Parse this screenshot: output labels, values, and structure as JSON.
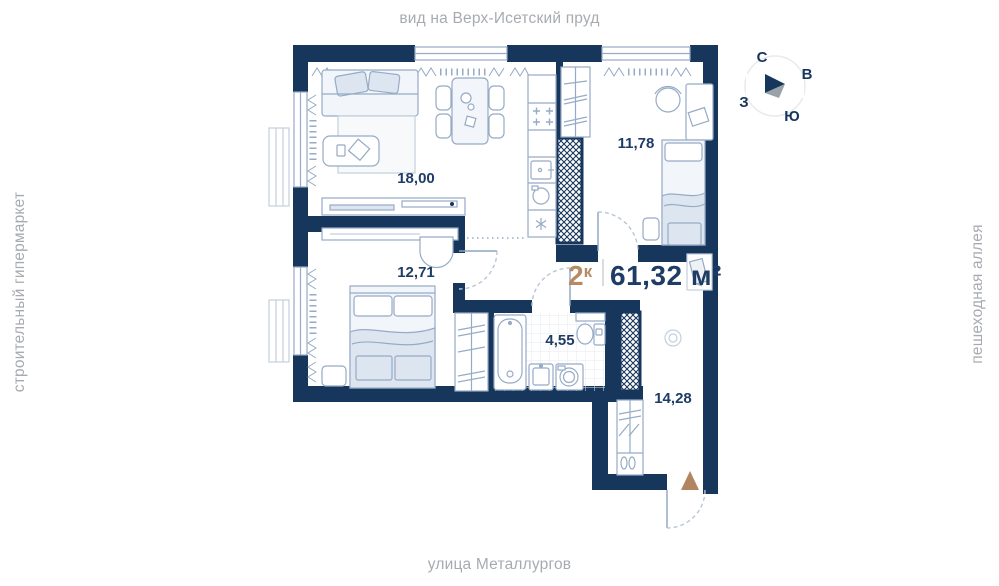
{
  "surroundings": {
    "top": "вид на Верх-Исетский пруд",
    "bottom": "улица Металлургов",
    "left": "строительный гипермаркет",
    "right": "пешеходная аллея"
  },
  "compass": {
    "north": "С",
    "east": "В",
    "south": "Ю",
    "west": "З"
  },
  "apartment": {
    "rooms_count": "2",
    "rooms_suffix": "к",
    "area": "61,32 м²"
  },
  "rooms": [
    {
      "name": "living-kitchen",
      "area": "18,00"
    },
    {
      "name": "bedroom-1",
      "area": "11,78"
    },
    {
      "name": "bedroom-2",
      "area": "12,71"
    },
    {
      "name": "bathroom",
      "area": "4,55"
    },
    {
      "name": "hallway",
      "area": "14,28"
    }
  ],
  "colors": {
    "wall": "#17365c",
    "furniture": "#96abc6",
    "label": "#1e3c66",
    "accent_tan": "#b18560",
    "muted_text": "#a7abb0"
  }
}
